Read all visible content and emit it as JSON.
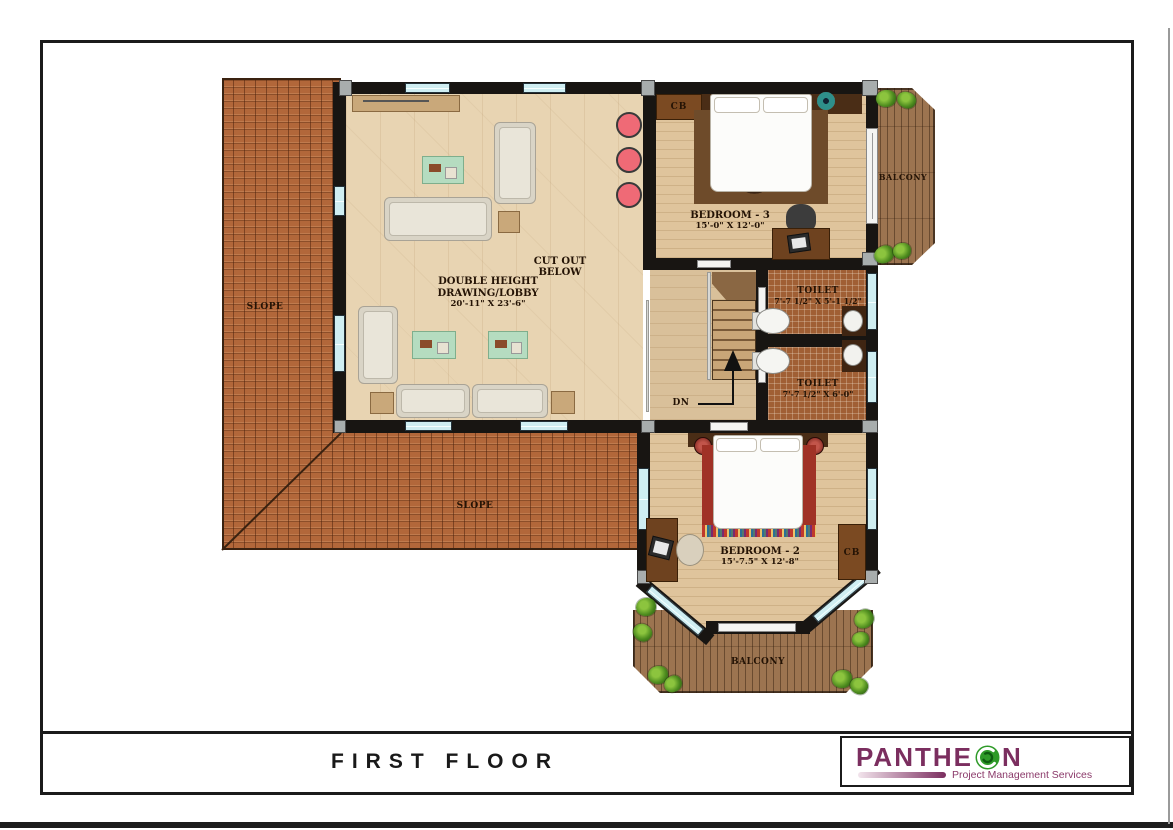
{
  "title_block": {
    "title": "FIRST FLOOR"
  },
  "logo": {
    "brand_left": "PANTHE",
    "brand_right": "N",
    "tagline": "Project Management Services",
    "brand_color": "#7b2e5f",
    "swirl_color": "#2e9a28"
  },
  "rooms": {
    "drawing_lobby": {
      "line1": "DOUBLE HEIGHT",
      "line2": "DRAWING/LOBBY",
      "dims": "20'-11\" X 23'-6\""
    },
    "cut_out": {
      "line1": "CUT OUT",
      "line2": "BELOW"
    },
    "bedroom3": {
      "name": "BEDROOM - 3",
      "dims": "15'-0\" X 12'-0\""
    },
    "bedroom2": {
      "name": "BEDROOM - 2",
      "dims": "15'-7.5\" X 12'-8\""
    },
    "toilet_upper": {
      "name": "TOILET",
      "dims": "7'-7 1/2\" X 5'-1 1/2\""
    },
    "toilet_lower": {
      "name": "TOILET",
      "dims": "7'-7 1/2\" X 6'-0\""
    },
    "balcony_right": {
      "name": "BALCONY"
    },
    "balcony_bottom": {
      "name": "BALCONY"
    },
    "roof_left": {
      "label": "SLOPE"
    },
    "roof_bottom": {
      "label": "SLOPE"
    },
    "closet_bedroom3": {
      "label": "CB"
    },
    "closet_bedroom2": {
      "label": "CB"
    },
    "stairs": {
      "label": "DN"
    }
  },
  "colors": {
    "roof": "#b2673a",
    "wall": "#181512",
    "window": "#cfeef2",
    "wood_light": "#e8d4b2",
    "wood_bedroom": "#dfc49c",
    "deck": "#9c7450",
    "toilet_floor": "#a05f34",
    "stool_accent": "#ef6a76"
  }
}
